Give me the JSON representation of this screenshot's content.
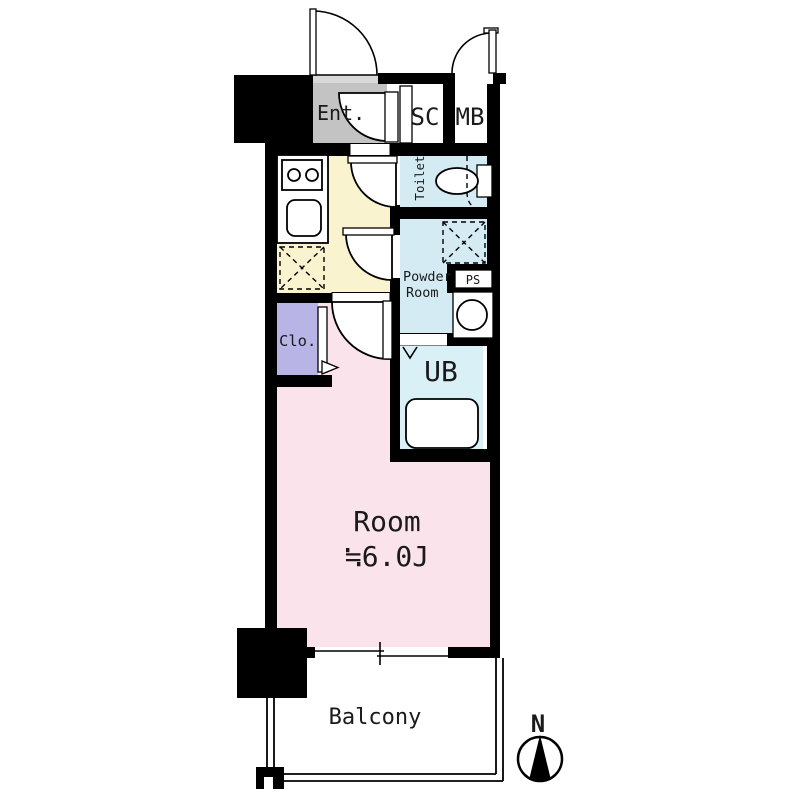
{
  "floor_plan": {
    "labels": {
      "entrance": "Ent.",
      "shoe_closet": "SC",
      "mail_box": "MB",
      "toilet": "Toilet",
      "powder_room_line1": "Powder",
      "powder_room_line2": "Room",
      "pipe_space": "PS",
      "unit_bath": "UB",
      "closet": "Clo.",
      "room": "Room",
      "room_size": "≒6.0J",
      "balcony": "Balcony",
      "compass_north": "N"
    },
    "colors": {
      "wall": "#000000",
      "entrance_floor": "#c3c3c3",
      "entrance_step": "#d8d8d8",
      "kitchen_floor": "#faf3cf",
      "wet_area_floor": "#d4ebf4",
      "unit_bath_floor": "#d9f0f6",
      "closet_floor": "#b9b4e6",
      "room_floor": "#fbe3ec"
    }
  }
}
